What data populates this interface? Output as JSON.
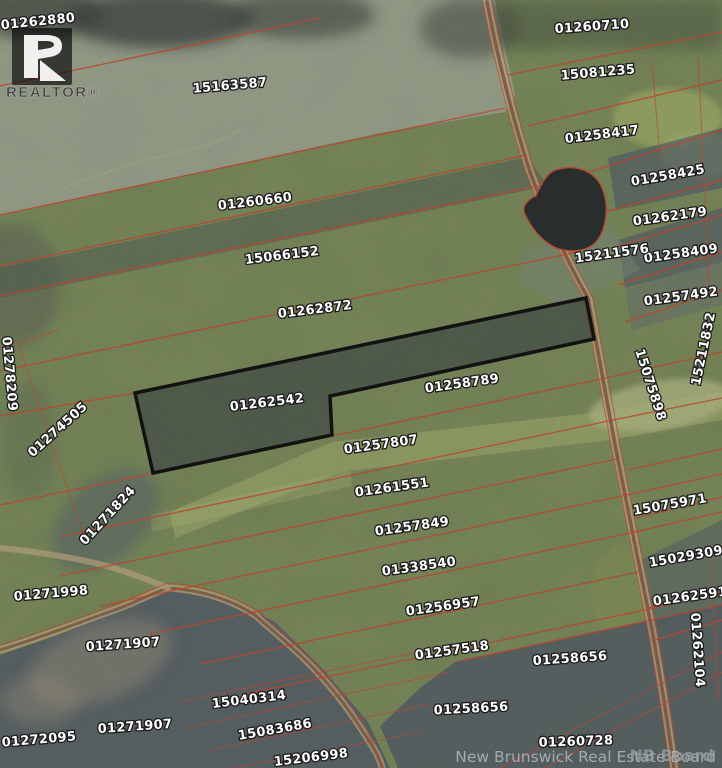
{
  "map": {
    "highlighted_parcel_id": "01262542",
    "parcels": [
      {
        "id": "01262880",
        "x": 38,
        "y": 22,
        "rot": -6
      },
      {
        "id": "15163587",
        "x": 230,
        "y": 86,
        "rot": -5
      },
      {
        "id": "01260710",
        "x": 592,
        "y": 27,
        "rot": -4
      },
      {
        "id": "15081235",
        "x": 598,
        "y": 73,
        "rot": -5
      },
      {
        "id": "01258417",
        "x": 602,
        "y": 135,
        "rot": -7
      },
      {
        "id": "01258425",
        "x": 668,
        "y": 176,
        "rot": -10
      },
      {
        "id": "01262179",
        "x": 670,
        "y": 217,
        "rot": -8
      },
      {
        "id": "01258409",
        "x": 681,
        "y": 254,
        "rot": -8
      },
      {
        "id": "01257492",
        "x": 681,
        "y": 297,
        "rot": -8
      },
      {
        "id": "15211576",
        "x": 612,
        "y": 254,
        "rot": -8
      },
      {
        "id": "15211832",
        "x": 704,
        "y": 349,
        "rot": -78
      },
      {
        "id": "01260660",
        "x": 255,
        "y": 202,
        "rot": -7
      },
      {
        "id": "15066152",
        "x": 282,
        "y": 256,
        "rot": -7
      },
      {
        "id": "01262872",
        "x": 315,
        "y": 310,
        "rot": -7
      },
      {
        "id": "01262542",
        "x": 267,
        "y": 403,
        "rot": -7,
        "highlighted": true
      },
      {
        "id": "01258789",
        "x": 462,
        "y": 384,
        "rot": -8
      },
      {
        "id": "01257807",
        "x": 381,
        "y": 445,
        "rot": -8
      },
      {
        "id": "01261551",
        "x": 392,
        "y": 488,
        "rot": -8
      },
      {
        "id": "01257849",
        "x": 412,
        "y": 527,
        "rot": -8
      },
      {
        "id": "01338540",
        "x": 419,
        "y": 567,
        "rot": -8
      },
      {
        "id": "01256957",
        "x": 443,
        "y": 607,
        "rot": -8
      },
      {
        "id": "01257518",
        "x": 452,
        "y": 651,
        "rot": -8
      },
      {
        "id": "01258656",
        "x": 570,
        "y": 659,
        "rot": -4
      },
      {
        "id": "01258656",
        "x": 471,
        "y": 709,
        "rot": -3
      },
      {
        "id": "01260728",
        "x": 576,
        "y": 742,
        "rot": -2
      },
      {
        "id": "15040314",
        "x": 249,
        "y": 700,
        "rot": -7
      },
      {
        "id": "15083686",
        "x": 275,
        "y": 730,
        "rot": -10
      },
      {
        "id": "15206998",
        "x": 311,
        "y": 758,
        "rot": -7
      },
      {
        "id": "01271998",
        "x": 51,
        "y": 594,
        "rot": -5
      },
      {
        "id": "01271907",
        "x": 123,
        "y": 645,
        "rot": -4
      },
      {
        "id": "01271907",
        "x": 135,
        "y": 727,
        "rot": -4
      },
      {
        "id": "01272095",
        "x": 39,
        "y": 740,
        "rot": -5
      },
      {
        "id": "01278209",
        "x": 9,
        "y": 374,
        "rot": 85
      },
      {
        "id": "01274505",
        "x": 58,
        "y": 430,
        "rot": -42
      },
      {
        "id": "01271824",
        "x": 108,
        "y": 516,
        "rot": -47
      },
      {
        "id": "15075898",
        "x": 650,
        "y": 385,
        "rot": 72
      },
      {
        "id": "15075971",
        "x": 670,
        "y": 505,
        "rot": -10
      },
      {
        "id": "15029309",
        "x": 686,
        "y": 557,
        "rot": -10
      },
      {
        "id": "01262591",
        "x": 690,
        "y": 597,
        "rot": -8
      },
      {
        "id": "01262104",
        "x": 697,
        "y": 650,
        "rot": 86
      }
    ]
  },
  "attribution": {
    "board_watermark": "New Brunswick Real Estate Board",
    "overlay_watermark": "NB Board",
    "realtor_wordmark": "REALTOR®"
  },
  "colors": {
    "base_green": "#6a7650",
    "band_dark": "#4d554d",
    "gray_parcel": "#8d9383",
    "dark_forest": "#3d433e",
    "cut_dark": "#4d555e",
    "pond": "#23282a",
    "road_tan": "#b09a74",
    "road_core": "#734e3e",
    "red_line": "#b5432f",
    "label_fill": "#ffffff",
    "label_stroke": "#1c1c1c",
    "watermark": "#b9bdc2",
    "highlight_outline": "#111111"
  }
}
